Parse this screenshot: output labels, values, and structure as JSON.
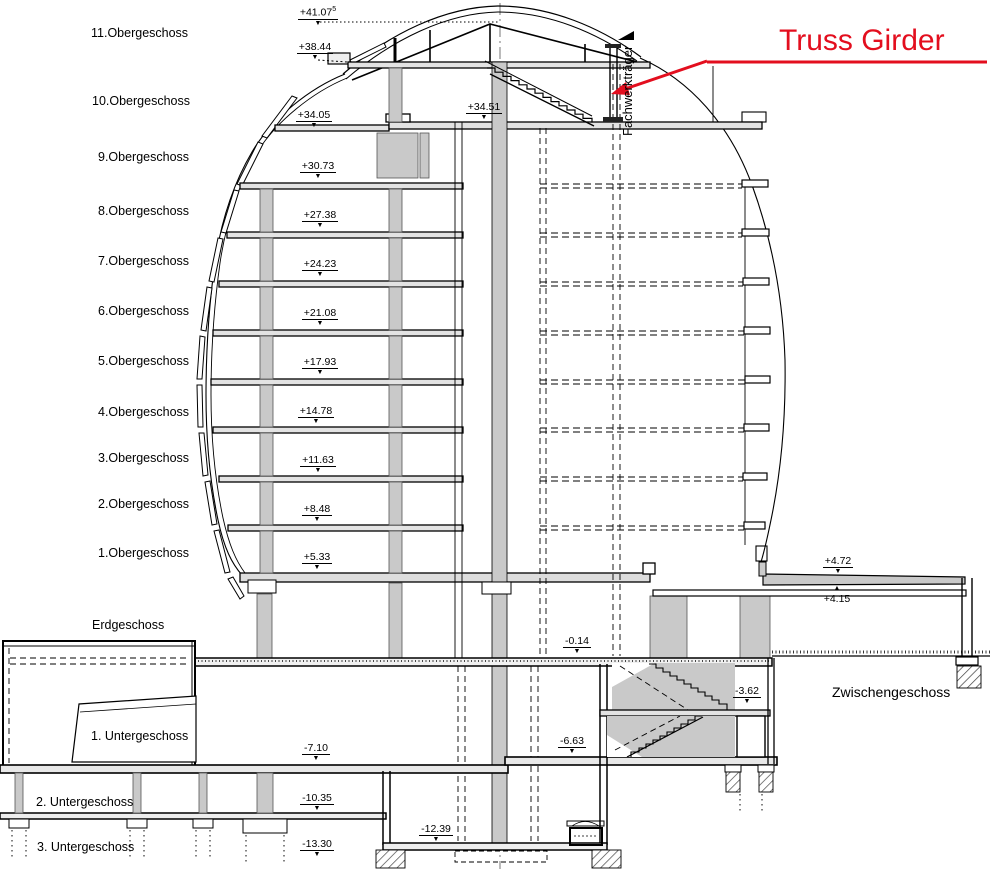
{
  "drawing": {
    "floor_labels": [
      {
        "id": "11-obergeschoss",
        "label": "11.Obergeschoss"
      },
      {
        "id": "10-obergeschoss",
        "label": "10.Obergeschoss"
      },
      {
        "id": "9-obergeschoss",
        "label": "9.Obergeschoss"
      },
      {
        "id": "8-obergeschoss",
        "label": "8.Obergeschoss"
      },
      {
        "id": "7-obergeschoss",
        "label": "7.Obergeschoss"
      },
      {
        "id": "6-obergeschoss",
        "label": "6.Obergeschoss"
      },
      {
        "id": "5-obergeschoss",
        "label": "5.Obergeschoss"
      },
      {
        "id": "4-obergeschoss",
        "label": "4.Obergeschoss"
      },
      {
        "id": "3-obergeschoss",
        "label": "3.Obergeschoss"
      },
      {
        "id": "2-obergeschoss",
        "label": "2.Obergeschoss"
      },
      {
        "id": "1-obergeschoss",
        "label": "1.Obergeschoss"
      },
      {
        "id": "erdgeschoss",
        "label": "Erdgeschoss"
      },
      {
        "id": "1-untergeschoss",
        "label": "1. Untergeschoss"
      },
      {
        "id": "2-untergeschoss",
        "label": "2. Untergeschoss"
      },
      {
        "id": "3-untergeschoss",
        "label": "3. Untergeschoss"
      }
    ],
    "elevation_markers": [
      {
        "value": "+41.07",
        "sup": "5"
      },
      {
        "value": "+38.44"
      },
      {
        "value": "+34.05"
      },
      {
        "value": "+34.51"
      },
      {
        "value": "+30.73"
      },
      {
        "value": "+27.38"
      },
      {
        "value": "+24.23"
      },
      {
        "value": "+21.08"
      },
      {
        "value": "+17.93"
      },
      {
        "value": "+14.78"
      },
      {
        "value": "+11.63"
      },
      {
        "value": "+8.48"
      },
      {
        "value": "+5.33"
      },
      {
        "value": "+4.72"
      },
      {
        "value": "+4.15"
      },
      {
        "value": "-0.14"
      },
      {
        "value": "-3.62"
      },
      {
        "value": "-6.63"
      },
      {
        "value": "-7.10"
      },
      {
        "value": "-10.35"
      },
      {
        "value": "-12.39"
      },
      {
        "value": "-13.30"
      }
    ],
    "annotations": {
      "truss_girder_label": "Truss Girder",
      "truss_girder_german_label": "Fachwerkträger",
      "mezzanine_label": "Zwischengeschoss"
    },
    "colors": {
      "annotation_red": "#e30e1e",
      "line_black": "#000000",
      "concrete_gray": "#c9c9c9",
      "slab_gray": "#e3e3e3"
    }
  }
}
